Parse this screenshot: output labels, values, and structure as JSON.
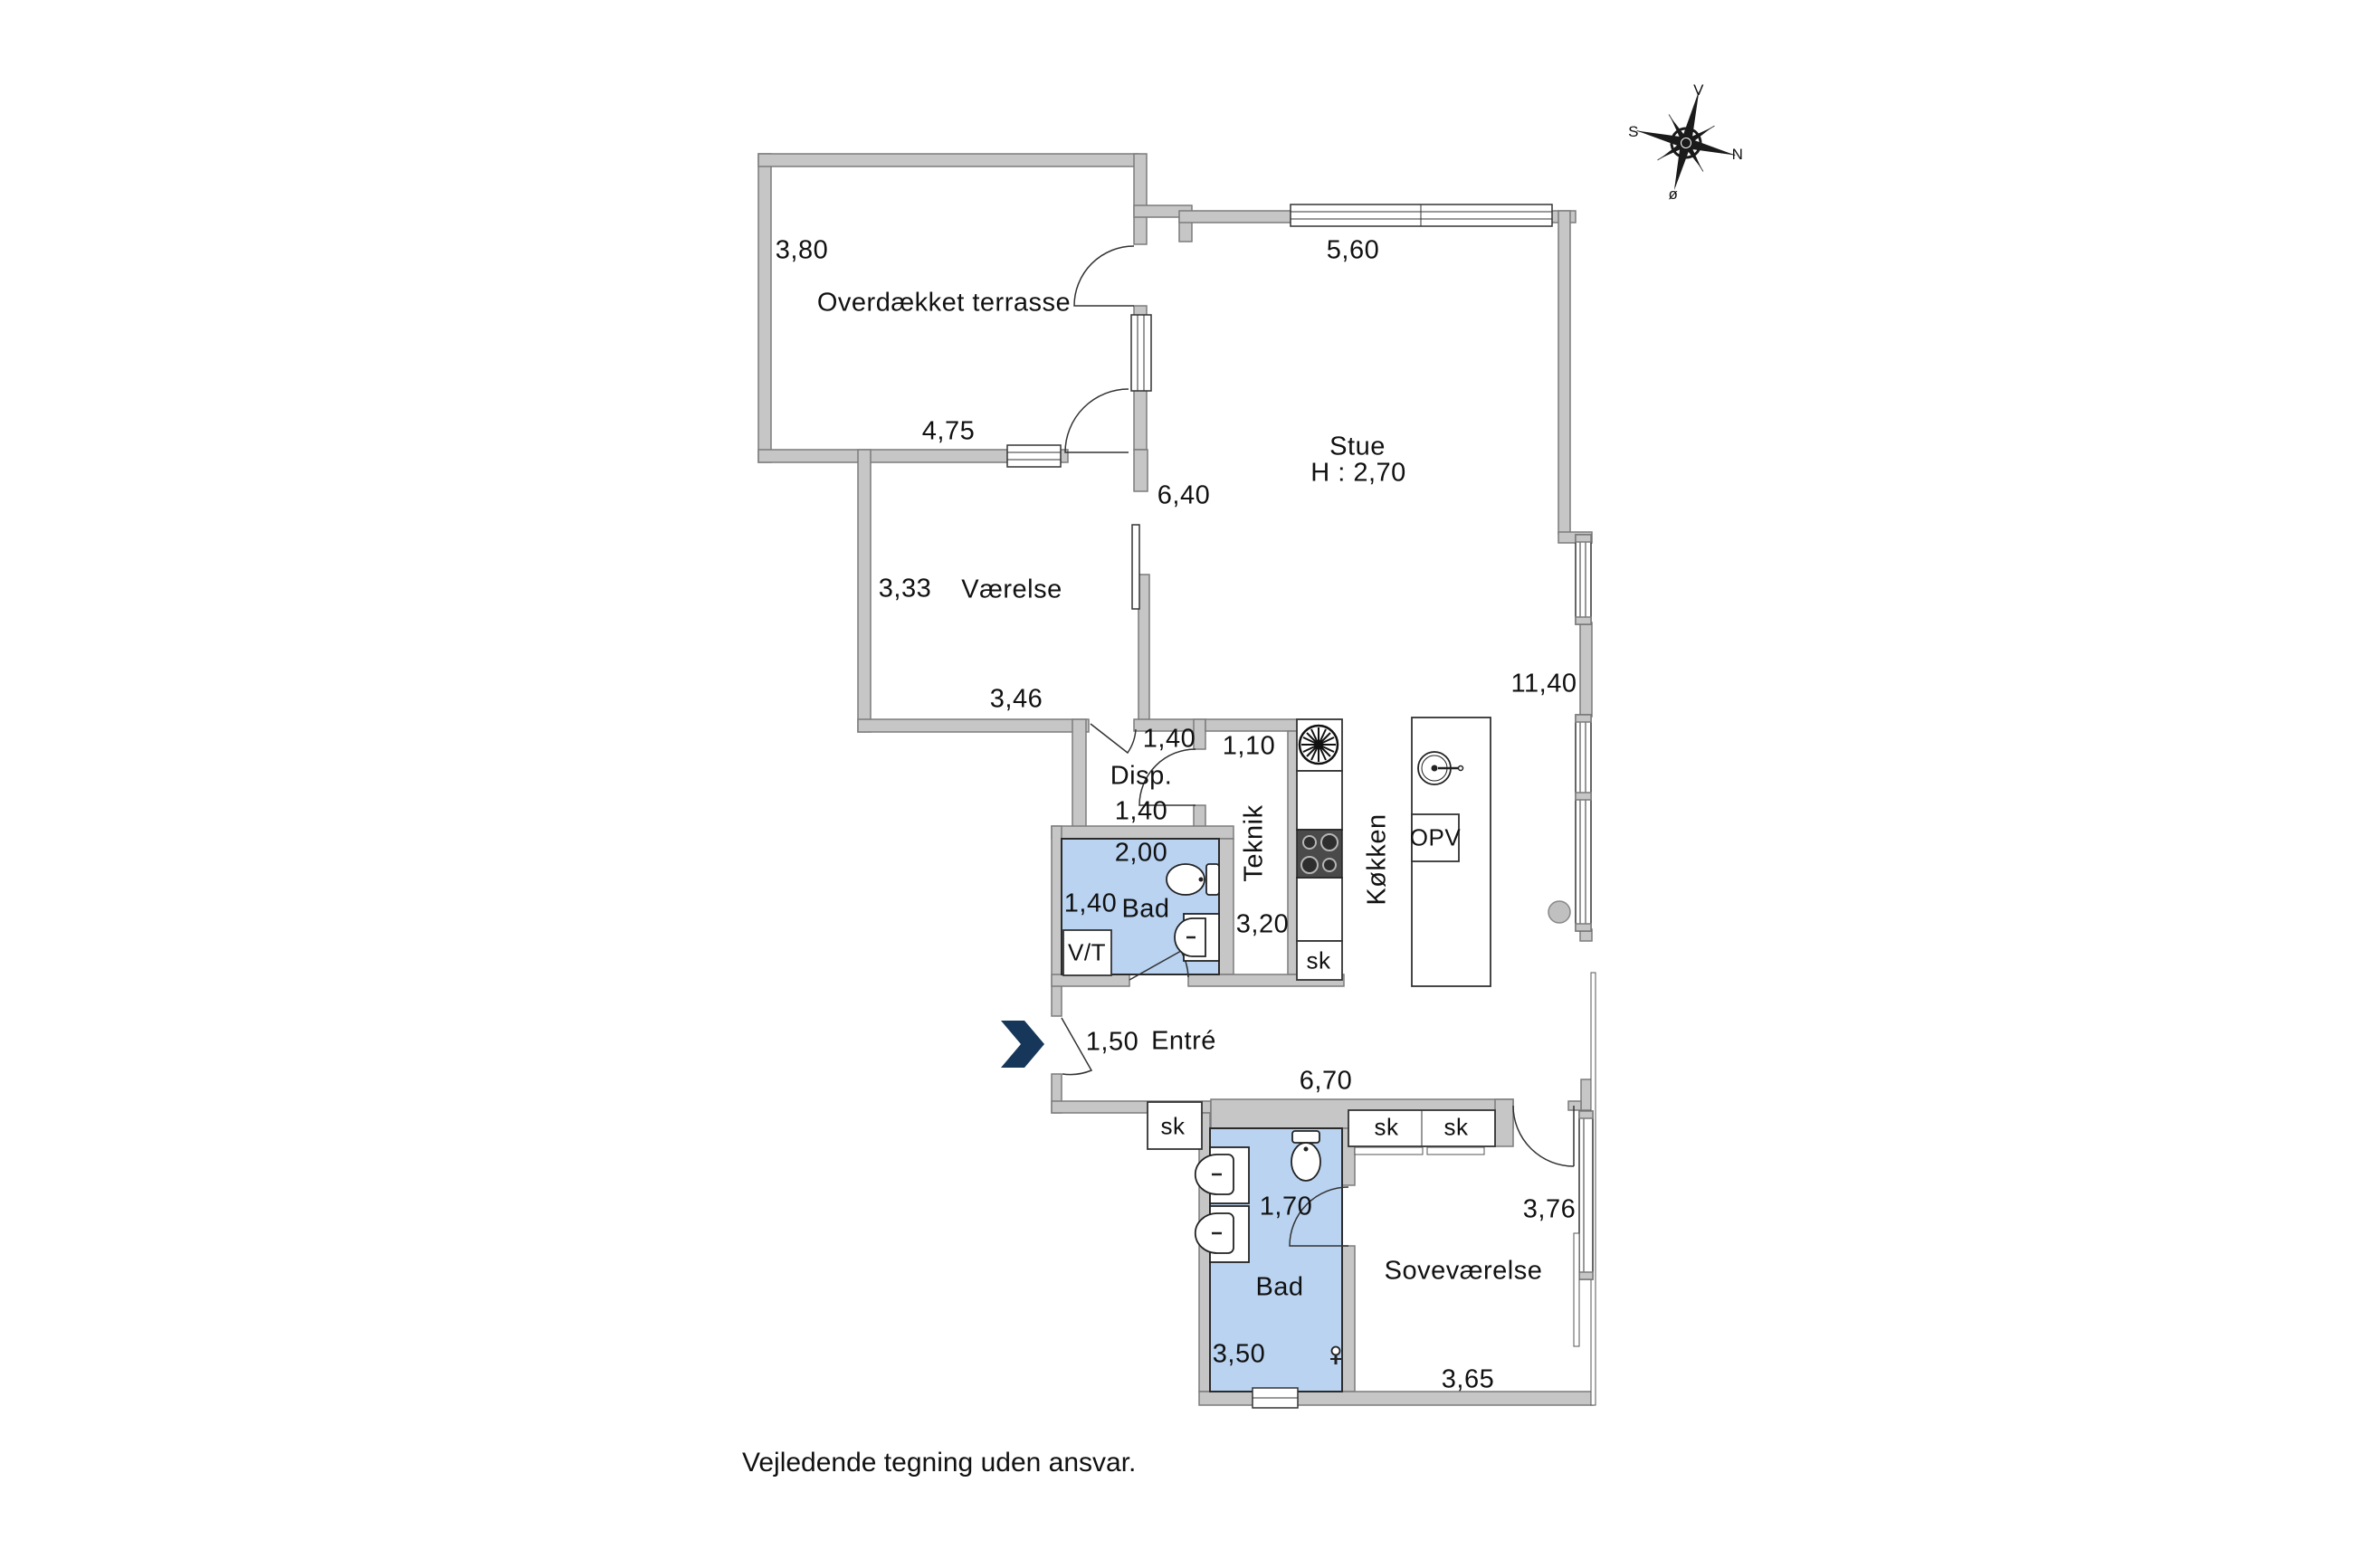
{
  "meta": {
    "disclaimer": "Vejledende tegning uden ansvar."
  },
  "colors": {
    "bathroom_fill": "#b9d3f1",
    "wall_fill": "#c6c6c6",
    "entrance_arrow": "#16375a"
  },
  "compass": {
    "up": "V",
    "left": "S",
    "right": "N",
    "down": "ø"
  },
  "rooms": {
    "terrasse": {
      "name": "Overdækket terrasse",
      "dim_side": "3,80",
      "dim_bottom": "4,75"
    },
    "stue": {
      "name": "Stue",
      "ceiling": "H : 2,70",
      "dim_top": "5,60",
      "dim_left": "6,40",
      "dim_right": "11,40"
    },
    "vaerelse": {
      "name": "Værelse",
      "dim_left": "3,33",
      "dim_bottom": "3,46"
    },
    "disp": {
      "name": "Disp.",
      "dim_top": "1,40",
      "dim_bottom": "1,40"
    },
    "teknik": {
      "name": "Teknik",
      "dim_top": "1,10",
      "dim_bottom": "3,20"
    },
    "bad1": {
      "name": "Bad",
      "dim_top": "2,00",
      "dim_left": "1,40",
      "vt": "V/T"
    },
    "koekken": {
      "name": "Køkken",
      "opv": "OPV",
      "sk": "sk"
    },
    "entre": {
      "name": "Entré",
      "dim_door": "1,50",
      "dim_bottom": "6,70",
      "sk": "sk"
    },
    "bad2": {
      "name": "Bad",
      "dim_top": "1,70",
      "dim_bottom": "3,50"
    },
    "sovevaerelse": {
      "name": "Soveværelse",
      "dim_right": "3,76",
      "dim_bottom": "3,65",
      "sk1": "sk",
      "sk2": "sk"
    }
  }
}
